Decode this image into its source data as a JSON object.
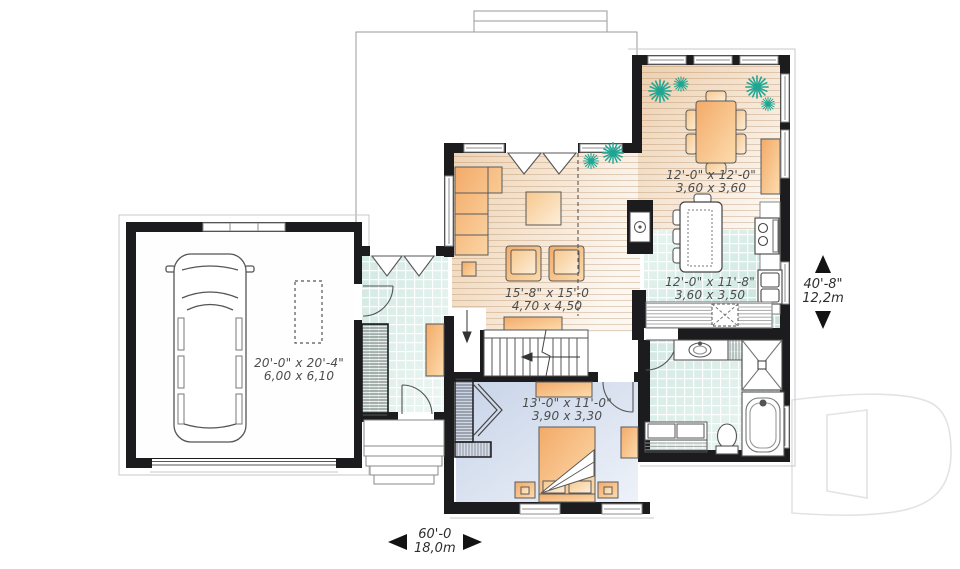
{
  "rooms": {
    "garage": {
      "imperial": "20'-0\" x 20'-4\"",
      "metric": "6,00 x 6,10"
    },
    "living": {
      "imperial": "15'-8\" x 15'-0",
      "metric": "4,70 x 4,50"
    },
    "dining": {
      "imperial": "12'-0\" x 12'-0\"",
      "metric": "3,60 x 3,60"
    },
    "kitchen": {
      "imperial": "12'-0\" x 11'-8\"",
      "metric": "3,60 x 3,50"
    },
    "bedroom": {
      "imperial": "13'-0\" x 11'-0\"",
      "metric": "3,90 x 3,30"
    }
  },
  "dimensions": {
    "width": {
      "imperial": "60'-0",
      "metric": "18,0m"
    },
    "height": {
      "imperial": "40'-8\"",
      "metric": "12,2m"
    }
  },
  "watermark": {
    "letter": "D"
  },
  "colors": {
    "wall": "#1c1c1e",
    "wood_floor": "#efd5b8",
    "tile_floor": "#d6eae4",
    "bedroom_floor": "#ccd7ea",
    "furniture": "#f4ad6c",
    "plant": "#1da693",
    "label_text": "#4c4c4c"
  }
}
